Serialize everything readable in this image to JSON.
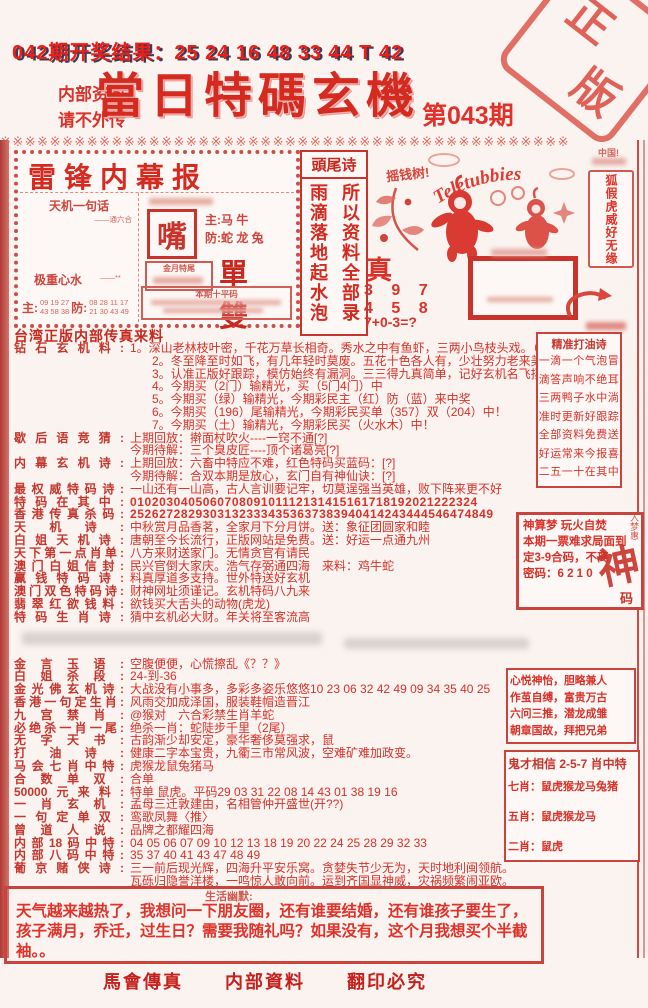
{
  "page": {
    "result_line": "042期开奖结果：25 24 16 48 33 44 T 42",
    "confidential_1": "内部资料",
    "confidential_2": "请不外传",
    "title": "當日特碼玄機",
    "issue": "第043期",
    "stamp_char_1": "正",
    "stamp_char_2": "版",
    "divider_char": "※",
    "accent_color": "#d42a20"
  },
  "leifeng": {
    "title": "雷锋内幕报",
    "tianji_label": "天机一句话",
    "tianji_sub": "——通六合",
    "xinshui_label": "极重心水",
    "xinshui_sub": "——**",
    "zhu_label": "主:",
    "zhu_numbers_1": "09 19 27",
    "zhu_numbers_2": "43 58 38",
    "fang_label": "防:",
    "fang_numbers_1": "08 28 11 17",
    "fang_numbers_2": "21 30 43 49",
    "mouth": "嘴",
    "zhu2": "主:马 牛",
    "fang2": "防:蛇 龙 兔",
    "tail_title": "金月特尾",
    "danshuang": "單 雙",
    "pingma_title": "本期十平码"
  },
  "touwei": {
    "header": "頭尾诗",
    "left_col": "雨滴落地起水泡",
    "right_col": "所以资料全部录"
  },
  "center": {
    "caption": "摇钱树!",
    "brand": "Teletubbies",
    "zhen": "真",
    "num1": "3 9 7",
    "num2": "4 5 8",
    "formula": "7+0-3=?"
  },
  "banner": {
    "note": "中国!",
    "text": "狐假虎威好无缘"
  },
  "main": {
    "source": "台湾正版内部传真来料",
    "lines": [
      {
        "l": "钻石玄机料:",
        "t": "1。深山老林枝叶密，千花万草长相奇。秀水之中有鱼虾，三两小鸟枝头戏。（蟾）"
      },
      {
        "l": "",
        "t": "2。冬至降至时如飞，有几年轻时莫废。五花十色各人有，少壮努力老来美。（蝇）",
        "c": "c"
      },
      {
        "l": "",
        "t": "3。认准正版好跟踪，模仿始终有漏洞。三三得九真简单，记好玄机名飞扬。（臂）",
        "c": "c"
      },
      {
        "l": "",
        "t": "4。今期买（2门）输精光，买（5门4门）中",
        "c": "c"
      },
      {
        "l": "",
        "t": "5。今期买（绿）输精光，今期彩民主（红）防（蓝）来中奖",
        "c": "c"
      },
      {
        "l": "",
        "t": "6。今期买（196）尾输精光，今期彩民买单（357）双（204）中！",
        "c": "c"
      },
      {
        "l": "",
        "t": "7。今期买（土）输精光，今期彩民买（火水木）中！",
        "c": "c"
      },
      {
        "l": "歇后语竞猜:",
        "t": "上期回放：擀面杖吹火----一窍不通[?]"
      },
      {
        "l": "",
        "t": "今期待解：三个臭皮匠----顶个诸葛亮[?]"
      },
      {
        "l": "内幕玄机诗:",
        "t": "上期回放：六畜中特应不难，红色特码买蓝码：[?]"
      },
      {
        "l": "",
        "t": "今期待解：合双本期是放心，玄门自有神仙诀：[?]"
      },
      {
        "l": "最权威特码诗:",
        "t": "一山还有一山高，古人言训要记牢，切莫逞强当英雄，败下阵来更不好"
      },
      {
        "l": "特码在其中:",
        "t": "010203040506070809101112131415161718192021222324",
        "c": "num"
      },
      {
        "l": "香港传真杀码:",
        "t": "25262728293031323334353637383940414243444546474849",
        "c": "num"
      },
      {
        "l": "天机诗:",
        "t": "中秋赏月品香茗，全家月下分月饼。送：象征团圆家和睦"
      },
      {
        "l": "白姐天机诗:",
        "t": "唐朝至今长流行，正版网站是免费。送：好运一点通九州"
      },
      {
        "l": "天下第一点肖单:",
        "t": "八方来财送家门。无情贪官有请民"
      },
      {
        "l": "澳门白姐信封:",
        "t": "民兴官倒大家庆。浩气存弼通四海　来料：鸡牛蛇"
      },
      {
        "l": "赢钱特码诗:",
        "t": "料真厚道多支持。世外特送好玄机"
      },
      {
        "l": "澳门双色特码诗:",
        "t": "财神网址须谨记。玄机特码八九来"
      },
      {
        "l": "翡翠红欲钱料:",
        "t": "欲钱买大舌头的动物(虎龙)"
      },
      {
        "l": "特码生肖诗:",
        "t": "猜中玄机必大财。年关将至客流高"
      },
      {
        "gap": true
      },
      {
        "l": "金言玉语:",
        "t": "空腹便便，心慌擦乱《？？》"
      },
      {
        "l": "白姐杀段:",
        "t": "24-到-36"
      },
      {
        "l": "金光佛玄机诗:",
        "t": "大战没有小事多，多彩多姿乐悠悠10 23 06 32 42 49 09 34 35 40 25"
      },
      {
        "l": "香港一句定生肖:",
        "t": "风雨交加成泽国，服装鞋帽造晋江"
      },
      {
        "l": "九宫禁肖:",
        "t": "@猴对　六合彩禁生肖羊蛇"
      },
      {
        "l": "必绝杀一肖一尾:",
        "t": "绝杀一肖：蛇陡步千里（2尾）"
      },
      {
        "l": "无字天书:",
        "t": "古韵渐少却安定，豪华奢侈莫强求，鼠"
      },
      {
        "l": "打油诗:",
        "t": "健康二字本宝贵，九衢三市常风波，空难矿难加政变。"
      },
      {
        "l": "马会七肖中特:",
        "t": "虎猴龙鼠兔猪马"
      },
      {
        "l": "合数单双:",
        "t": "合单"
      },
      {
        "l": "50000元来料:",
        "t": "特单 鼠虎。平码29 03 31 22 08 14 43 01 38 19 16"
      },
      {
        "l": "一肖玄机:",
        "t": "孟母三迁敦建由，名相管仲开盛世(开??)"
      },
      {
        "l": "一句定单双:",
        "t": "鸾歌凤舞〈推〉"
      },
      {
        "l": "曾道人说:",
        "t": "品牌之都耀四海"
      },
      {
        "l": "内部18码中特:",
        "t": "04 05 06 07 09 10 12 13 18 19 20 22 24 25 28 29 32 33"
      },
      {
        "l": "内部八码中特:",
        "t": "35 37 40 41 43 47 48 49"
      },
      {
        "l": "葡京赌侠诗:",
        "t": "三一前后现光辉，四海升平安乐窝。贪婪失节少无为，天时地利闽领航。"
      },
      {
        "l": "",
        "t": "瓦砾归隐誉洋楼，一鸣惊人敢向前。运到齐国显神威，灾祸频繁闹亚欧。"
      }
    ]
  },
  "boxes": {
    "dayou": {
      "title": "精准打油诗",
      "lines": [
        "一滴一个气泡冒",
        "滴答声响不绝耳",
        "三两鸭子水中淌",
        "准时更新好跟踪",
        "全部资料免费送",
        "好运常来今报喜",
        "二五一十在其中"
      ]
    },
    "shensuan": {
      "line1": "神算梦 玩火自焚",
      "line2": "本期一票难求局面到",
      "line3": "定3-9合码，不离",
      "line4": "密码：6 2 1 0",
      "seal_big": "神",
      "seal_small": "码",
      "seal_side": "入梦惠"
    },
    "idioms": {
      "lines": [
        "心悦神怡，胆略兼人",
        "作茧自缚，富贵万古",
        "六问三推，潜龙成雏",
        "朝章国故，拜把兄弟"
      ]
    },
    "guicai": {
      "title": "鬼才相信 2-5-7 肖中特",
      "lines": [
        "七肖：鼠虎猴龙马兔猪",
        "五肖：鼠虎猴龙马",
        "二肖：鼠虎"
      ]
    }
  },
  "humor": {
    "label": "生活幽默:",
    "text": "天气越来越热了，我想问一下朋友圈，还有谁要结婚，还有谁孩子要生了，孩子满月，乔迁，过生日？需要我随礼吗？如果没有，这个月我想买个半截袖。。"
  },
  "footer": {
    "items": [
      "馬會傳真",
      "内部資料",
      "翻印必究"
    ]
  }
}
